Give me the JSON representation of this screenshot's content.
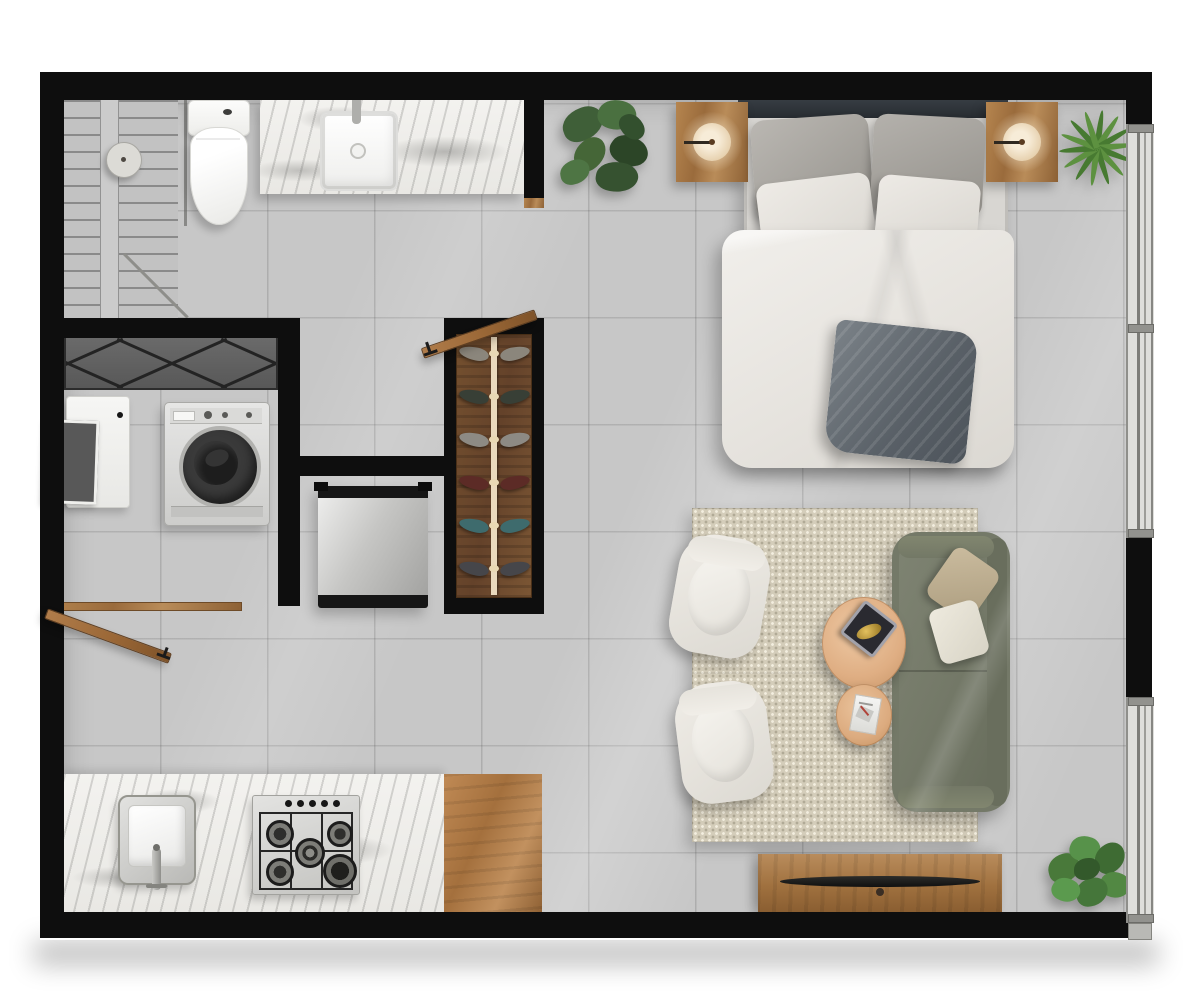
{
  "scene": {
    "type": "floor-plan",
    "view": "top-down 3d render",
    "unit": "studio apartment"
  },
  "palette": {
    "wall": "#0e0e0e",
    "floor_tile": "#c7c7c7",
    "wood": "#9a6b3c",
    "marble": "#f0efec",
    "rug": "#d4cdba",
    "sofa": "#767b6a",
    "armchair": "#e9e6df",
    "coffee_table": "#e0b28c",
    "duvet": "#ece9e5",
    "throw_blanket": "#6e757b",
    "plant_dark": "#3f5f38",
    "plant_bright": "#5d9140",
    "lamp_glow": "#f4e6cf",
    "stainless": "#d6d6d4"
  },
  "rooms": [
    {
      "id": "bathroom",
      "items": [
        "shower",
        "glass-partition",
        "rain-shower-head",
        "toilet",
        "vanity-counter",
        "vanity-sink",
        "faucet"
      ]
    },
    {
      "id": "laundry-closet",
      "items": [
        "sliding-wardrobe",
        "laundry-sink",
        "washing-machine",
        "closet-door"
      ]
    },
    {
      "id": "hallway",
      "items": [
        "shoe-rack",
        "refrigerator",
        "bathroom-door"
      ]
    },
    {
      "id": "kitchen",
      "items": [
        "marble-counter",
        "wood-counter",
        "kitchen-sink",
        "kitchen-faucet",
        "gas-cooktop"
      ]
    },
    {
      "id": "bedroom",
      "items": [
        "headboard",
        "double-bed",
        "gray-pillows",
        "white-pillows",
        "duvet",
        "throw-blanket",
        "nightstand-left",
        "nightstand-right",
        "disc-lamp-left",
        "disc-lamp-right",
        "monstera-plant",
        "yucca-plant"
      ]
    },
    {
      "id": "living-room",
      "items": [
        "area-rug",
        "armchair-top",
        "armchair-bottom",
        "sofa",
        "sofa-pillow-tan",
        "sofa-pillow-white",
        "coffee-table-large",
        "decor-tray",
        "coffee-table-small",
        "magazine",
        "tv-console",
        "tv-soundbar",
        "pothos-plant"
      ]
    }
  ],
  "windows": [
    {
      "id": "window-upper-right",
      "side": "right",
      "panes": 2
    },
    {
      "id": "window-lower-right",
      "side": "right",
      "panes": 2
    }
  ],
  "cooktop": {
    "burners": 5,
    "knobs": 5
  },
  "shoe_rack": {
    "pairs": 6,
    "colors": [
      "#8b867c",
      "#383f36",
      "#8d8a84",
      "#5c2b26",
      "#3e6b6d",
      "#46464a"
    ]
  }
}
